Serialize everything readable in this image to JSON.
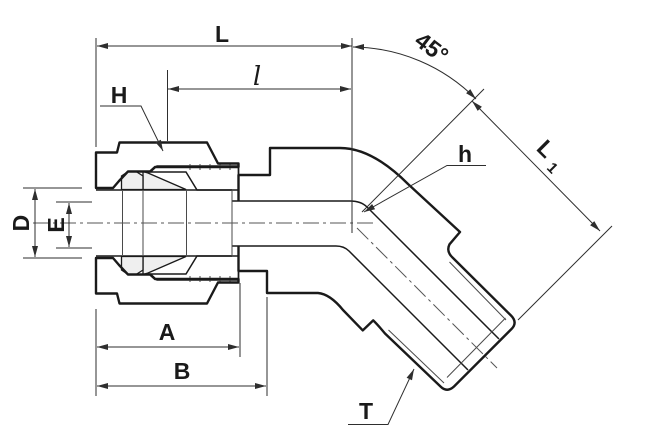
{
  "canvas": {
    "width": 656,
    "height": 438,
    "background": "#ffffff"
  },
  "colors": {
    "outline": "#1a1a1a",
    "dimension_line": "#2e2e2e",
    "body_fill": "#dcdcdc",
    "nut_fill": "#c6c6c6",
    "hatch_line": "#8f8f8f",
    "ferrule_fill": "#efefef",
    "background": "#ffffff"
  },
  "labels": {
    "overall_length": "L",
    "insert_length": "l",
    "bend_angle": "45°",
    "nut_hex_flats": "H",
    "body_hex_flats": "h",
    "l1_base": "L",
    "l1_sub": "1",
    "outer_diameter": "D",
    "inner_diameter": "E",
    "length_a": "A",
    "length_b": "B",
    "thread": "T"
  }
}
